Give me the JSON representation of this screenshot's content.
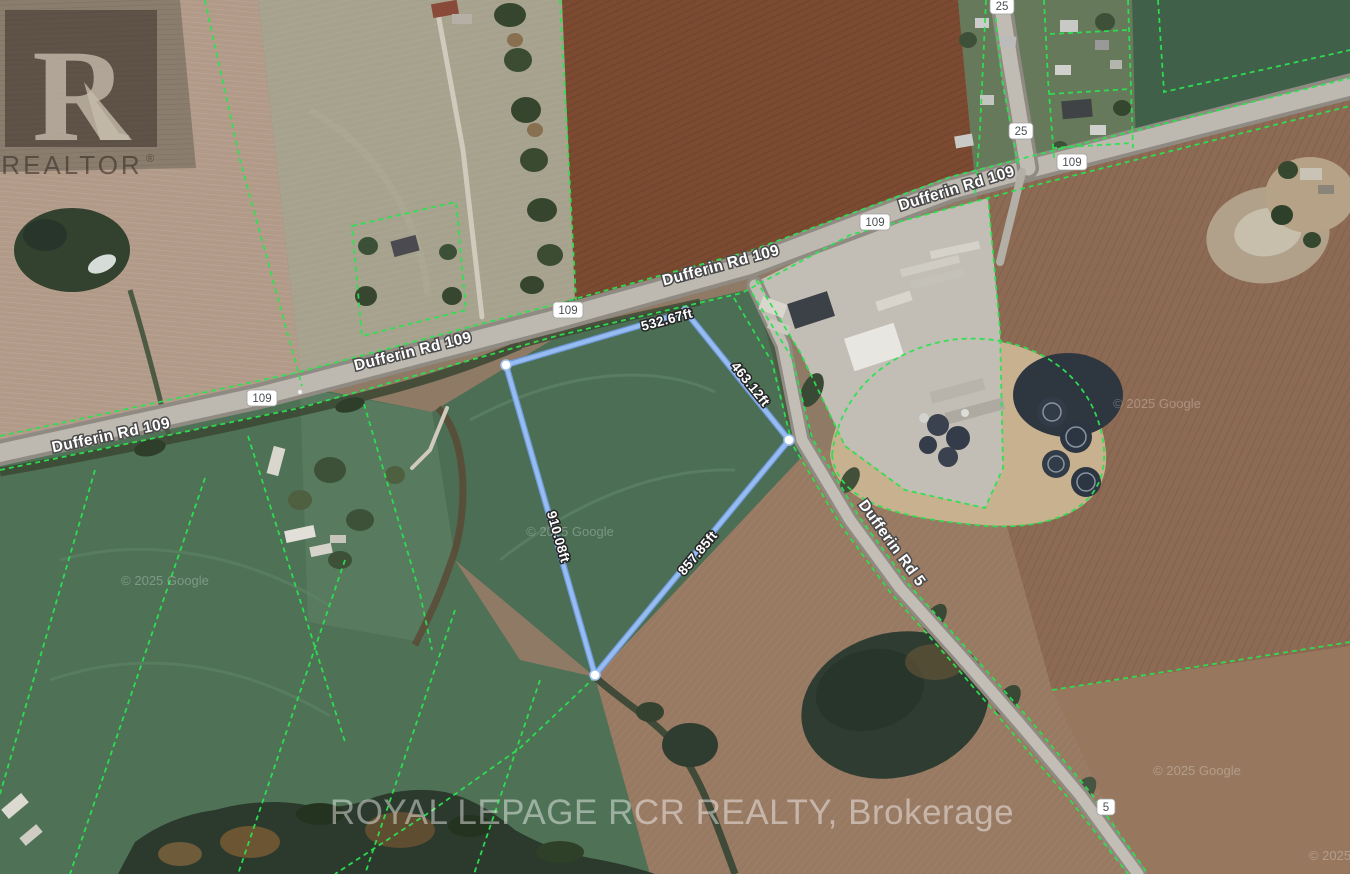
{
  "map": {
    "roads": {
      "dufferin_rd_109": "Dufferin Rd 109",
      "dufferin_rd_5": "Dufferin Rd 5",
      "shield_109": "109",
      "shield_25": "25",
      "shield_5": "5"
    },
    "property_measurements": {
      "north_side": "532.67ft",
      "east_side": "463.12ft",
      "west_side": "910.08ft",
      "south_side": "857.85ft"
    },
    "watermarks": {
      "realtor_letter": "R",
      "realtor_label": "REALTOR",
      "registered_symbol": "®",
      "brokerage": "ROYAL LEPAGE RCR REALTY, Brokerage",
      "imagery_credit": "© 2025 Google",
      "imagery_credit_partial": "© 2025"
    },
    "colors": {
      "parcel_line_green": "#2ce250",
      "property_boundary_blue": "#8ab2ec",
      "road_fill": "#bdb9b1",
      "label_text": "#ffffff",
      "shield_text": "#4a4e52"
    }
  }
}
